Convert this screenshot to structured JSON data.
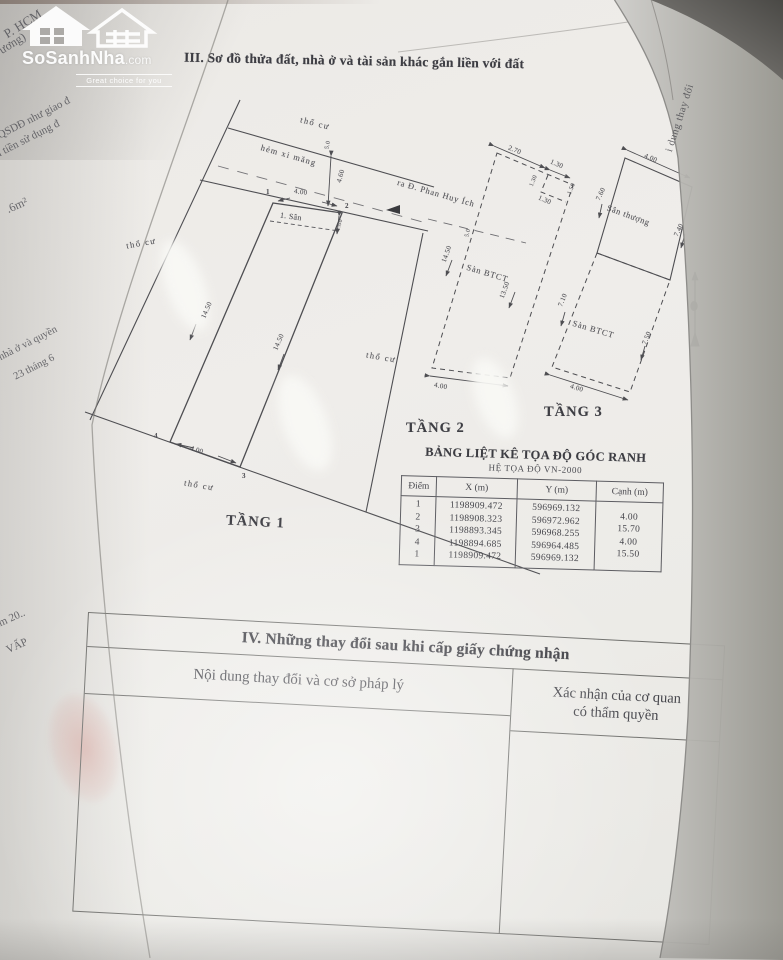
{
  "logo": {
    "brand": "SoSanhNha",
    "tld": ".com",
    "tagline": "Great choice for you"
  },
  "section3_title": "III. Sơ đồ thửa đất, nhà ở và tài sản khác gắn liền với đất",
  "fragments": {
    "top_a": "P. HCM",
    "top_b": "ương)",
    "left_a": "QSDĐ như giao đ",
    "left_b": "u tiền sử dụng đ",
    "left_c": ".6m²",
    "left_d": "nhà ở và quyền",
    "left_e": "23 tháng 6",
    "left_f": "m 20..",
    "left_g": "VẤP",
    "fold_text": "i dung thay đổi"
  },
  "diagram": {
    "land_label": "thổ cư",
    "alley_label": "hẻm xi măng",
    "street_label": "ra Đ. Phan Huy Ích",
    "alley_width": "4.60",
    "alley_note": "5.0",
    "floor1": {
      "name": "TẦNG 1",
      "front_dim": "4.00",
      "back_dim": "4.00",
      "left_dim": "14.50",
      "right_dim": "14.50",
      "yard_label": "1. Sân",
      "yard_depth": "1.00",
      "corner1": "1",
      "corner2": "2",
      "corner3": "3",
      "corner4": "4"
    },
    "floor2": {
      "name": "TẦNG 2",
      "slab_label": "Sàn BTCT",
      "top_dim_a": "2.70",
      "top_dim_b": "1.30",
      "notch_dim": "1.30",
      "notch_side_a": "1.30",
      "notch_side_b": "1.50",
      "left_dim": "14.50",
      "right_dim": "13.50",
      "bottom_dim": "4.00"
    },
    "floor3": {
      "name": "TẦNG 3",
      "terrace_label": "Sân thượng",
      "slab_label": "Sàn BTCT",
      "terrace_top_dim": "4.00",
      "terrace_left_dim": "7.60",
      "terrace_right_dim": "7.40",
      "slab_left_dim": "7.10",
      "slab_right_dim": "7.50",
      "slab_bottom_dim": "4.00"
    }
  },
  "coord_table": {
    "title": "BẢNG LIỆT KÊ TỌA ĐỘ GÓC RANH",
    "subtitle": "HỆ TỌA ĐỘ VN-2000",
    "headers": [
      "Điểm",
      "X (m)",
      "Y (m)",
      "Cạnh (m)"
    ],
    "rows": [
      {
        "point": "1",
        "x": "1198909.472",
        "y": "596969.132",
        "edge": ""
      },
      {
        "point": "2",
        "x": "1198908.323",
        "y": "596972.962",
        "edge": "4.00"
      },
      {
        "point": "3",
        "x": "1198893.345",
        "y": "596968.255",
        "edge": "15.70"
      },
      {
        "point": "4",
        "x": "1198894.685",
        "y": "596964.485",
        "edge": "4.00"
      },
      {
        "point": "1",
        "x": "1198909.472",
        "y": "596969.132",
        "edge": "15.50"
      }
    ]
  },
  "section4": {
    "title": "IV. Những thay đổi sau khi cấp giấy chứng nhận",
    "col1": "Nội dung thay đổi và cơ sở pháp lý",
    "col2_line1": "Xác nhận của cơ quan",
    "col2_line2": "có thẩm quyền"
  }
}
